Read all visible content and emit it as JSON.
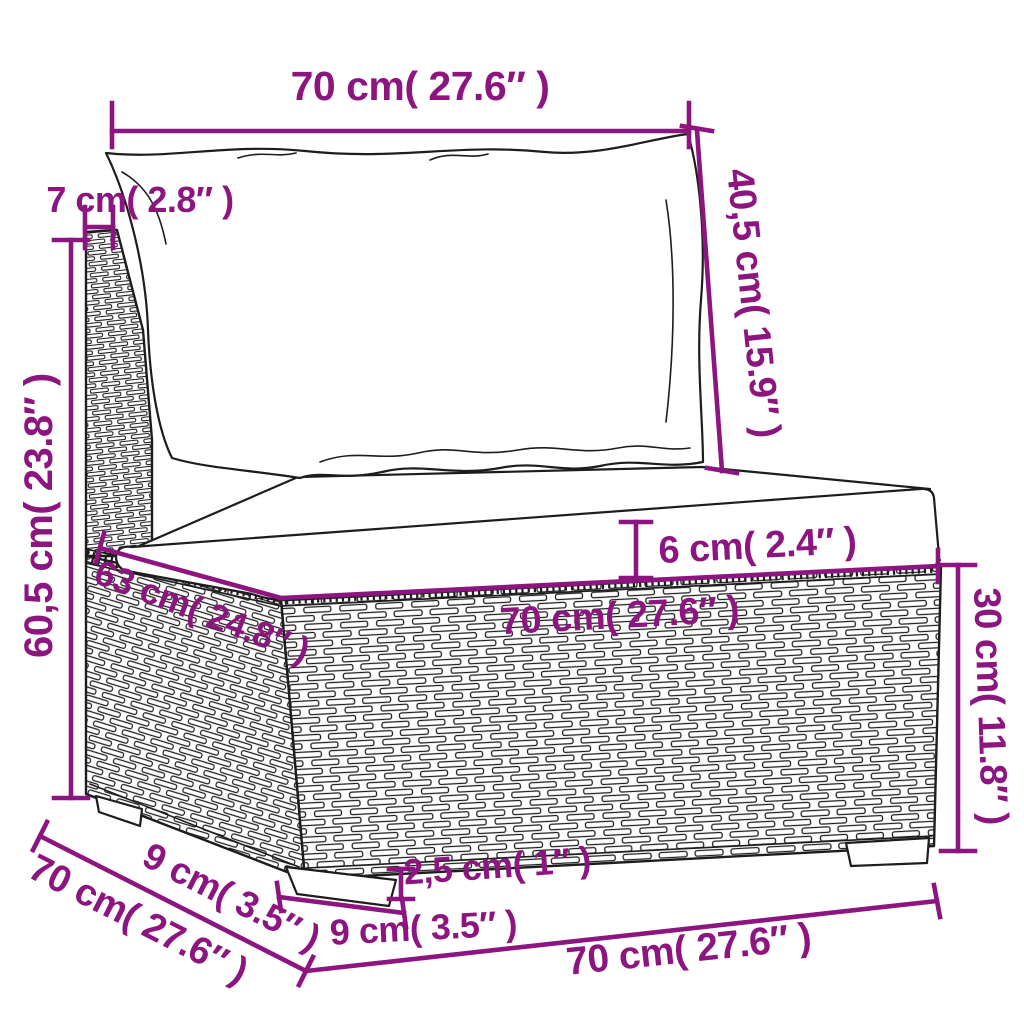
{
  "diagram": {
    "type": "furniture-dimension-diagram",
    "subject": "poly rattan garden sofa middle section with back and seat cushions",
    "colors": {
      "dimension_color": "#8d157f",
      "line_color": "#1d1d1d",
      "background_color": "#ffffff"
    },
    "dimensions": {
      "back_cushion_width": "70 cm( 27.6″  )",
      "back_post_depth": "7 cm( 2.8″  )",
      "back_cushion_height": "40,5 cm( 15.9″  )",
      "total_height": "60,5 cm( 23.8″  )",
      "seat_cushion_thickness": "6 cm( 2.4″  )",
      "seat_depth": "63 cm( 24.8″  )",
      "seat_width": "70 cm( 27.6″  )",
      "base_height": "30 cm( 11.8″  )",
      "base_depth": "70 cm( 27.6″  )",
      "leg_inset_depth": "9 cm( 3.5″  )",
      "leg_height": "2,5 cm( 1″  )",
      "leg_width": "9 cm( 3.5″  )",
      "base_width": "70 cm( 27.6″  )"
    }
  }
}
